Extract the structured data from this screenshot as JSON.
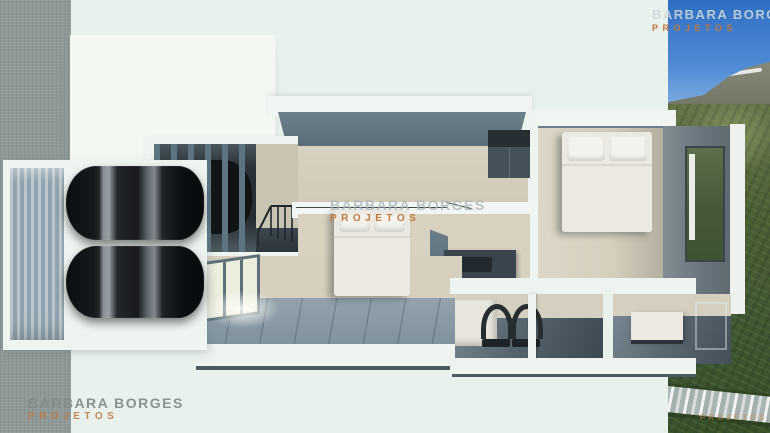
{
  "watermarks": {
    "top_right": {
      "line1": "BARBARA BORGES",
      "line2": "PROJETOS"
    },
    "center": {
      "line1": "BARBARA BORGES",
      "line2": "PROJETOS"
    },
    "bottom_left": {
      "line1": "BARBARA BORGES",
      "line2": "PROJETOS"
    },
    "bottom_right": {
      "line2": "PROJETOS"
    }
  },
  "scene": {
    "type": "3d-top-down-floorplan-render",
    "rooms": [
      "garage",
      "carport-pergola",
      "stair-hall",
      "upper-hall",
      "center-bedroom",
      "right-bedroom",
      "bathroom",
      "small-room"
    ],
    "furniture": [
      "car",
      "car",
      "car-under-pergola",
      "double-bed-center",
      "double-bed-right",
      "double-sink-vanity",
      "wardrobe",
      "counter"
    ],
    "backdrop": [
      "textured-grey-wall-left",
      "sky-and-mountain-top-right",
      "green-hillside-right",
      "river-bottom-right"
    ]
  },
  "colors": {
    "background": "#e9f1ec",
    "wall_top_white": "#f0f5f1",
    "wall_side_grey": "#647884",
    "floor_beige": "#d8d1c0",
    "floor_plank_blue": "#8da0ac",
    "garage_floor": "#7e93a1",
    "car_black": "#111416",
    "sky_blue": "#3b79cb",
    "mountain_grey": "#7c8170",
    "hill_green": "#475b35",
    "river_grey": "#aab6b3",
    "left_wall_texture": "#8f9997",
    "watermark_grey": "#aab4b6",
    "watermark_orange": "#c0763c"
  }
}
